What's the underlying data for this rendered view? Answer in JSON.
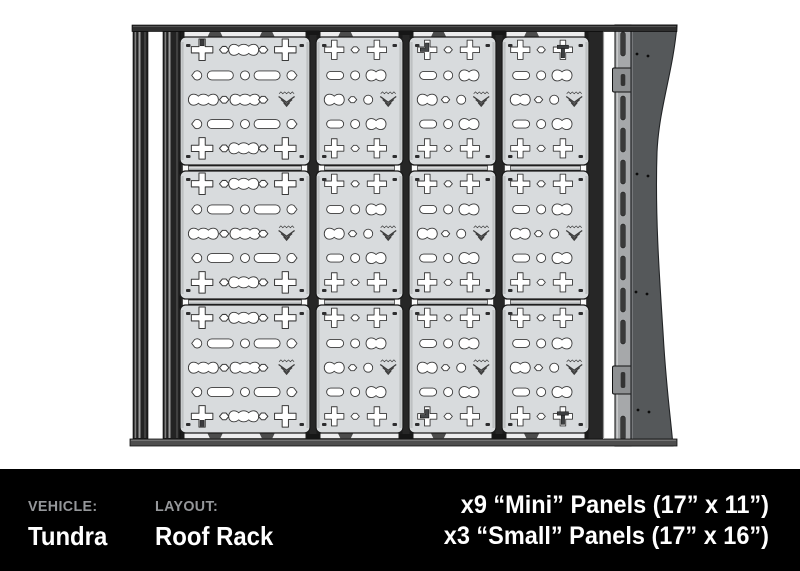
{
  "footer": {
    "vehicle_label": "VEHICLE:",
    "vehicle_value": "Tundra",
    "layout_label": "LAYOUT:",
    "layout_value": "Roof Rack",
    "panel_specs": [
      "x9 “Mini” Panels (17” x 11”)",
      "x3 “Small” Panels (17” x 16”)"
    ],
    "colors": {
      "background": "#000000",
      "label": "#95979a",
      "value": "#ffffff"
    }
  },
  "diagram": {
    "title": "Roof rack top view with perforated accessory panels",
    "grid": {
      "rows": 3,
      "columns": 4
    },
    "column_types": [
      "small",
      "mini",
      "mini",
      "mini"
    ],
    "panel_types": {
      "mini": {
        "name": "Mini",
        "size": "17” x 11”",
        "count": 9,
        "cutout_rows": [
          [
            "plus",
            "diamond",
            "plus"
          ],
          [
            "pill",
            "circle",
            "peanut2"
          ],
          [
            "peanut2",
            "diamond",
            "circle",
            "chevron-logo"
          ],
          [
            "pill",
            "circle",
            "peanut2"
          ],
          [
            "plus",
            "diamond",
            "plus"
          ]
        ]
      },
      "small": {
        "name": "Small",
        "size": "17” x 16”",
        "count": 3,
        "cutout_rows": [
          [
            "plus",
            "diamond",
            "peanut3",
            "diamond",
            "plus"
          ],
          [
            "teardrop",
            "pill-long",
            "circle",
            "pill-long",
            "teardrop"
          ],
          [
            "peanut3",
            "diamond",
            "peanut3",
            "diamond",
            "chevron-logo"
          ],
          [
            "teardrop",
            "pill-long",
            "circle",
            "pill-long",
            "teardrop"
          ],
          [
            "plus",
            "diamond",
            "peanut3",
            "diamond",
            "plus"
          ]
        ]
      }
    },
    "accessory_hooks": [
      {
        "col": 0,
        "row": 0,
        "pos": "left",
        "kind": "tab-top"
      },
      {
        "col": 2,
        "row": 0,
        "pos": "left",
        "kind": "hook"
      },
      {
        "col": 3,
        "row": 0,
        "pos": "right",
        "kind": "tee"
      },
      {
        "col": 0,
        "row": 2,
        "pos": "left",
        "kind": "tab-bottom"
      },
      {
        "col": 2,
        "row": 2,
        "pos": "left",
        "kind": "hook"
      },
      {
        "col": 3,
        "row": 2,
        "pos": "right",
        "kind": "tee"
      }
    ],
    "colors": {
      "panel_fill": "#d8dbdd",
      "panel_stroke": "#1b1b1b",
      "cutout_fill": "#ffffff",
      "cutout_stroke": "#3a3a3a",
      "frame_dark": "#262626",
      "rail_fill": "#a6a8aa",
      "fairing_fill": "#55585a",
      "logo_mark": "#3d3d3d"
    }
  }
}
